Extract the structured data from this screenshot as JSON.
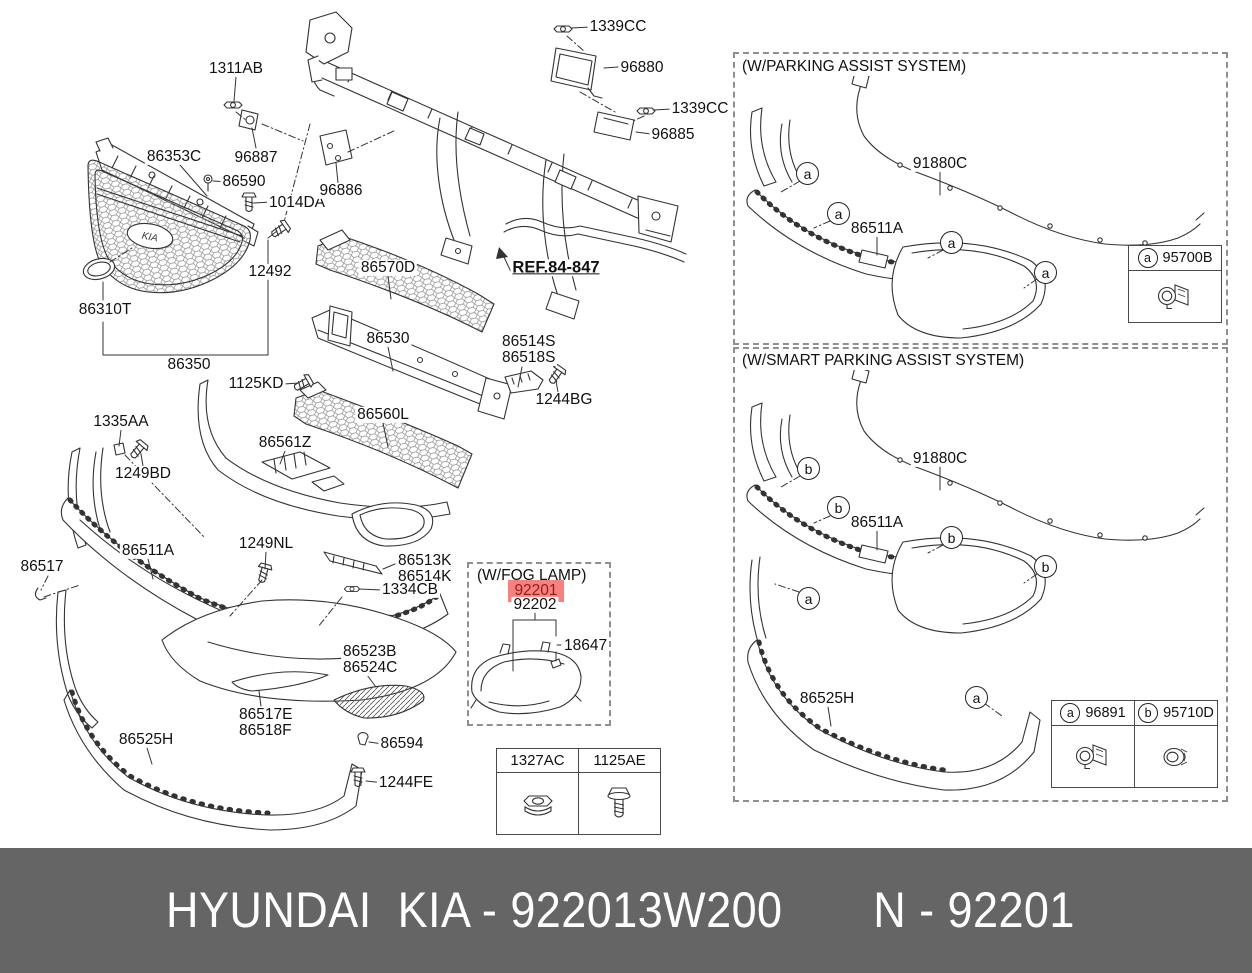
{
  "parts": {
    "1311AB": "1311AB",
    "96887": "96887",
    "86353C": "86353C",
    "86590": "86590",
    "1014DA": "1014DA",
    "96886": "96886",
    "12492": "12492",
    "86310T": "86310T",
    "86350": "86350",
    "86570D": "86570D",
    "86530": "86530",
    "86514S": "86514S",
    "86518S": "86518S",
    "1244BG": "1244BG",
    "86560L": "86560L",
    "86561Z": "86561Z",
    "1125KD": "1125KD",
    "1335AA": "1335AA",
    "1249BD": "1249BD",
    "86511A": "86511A",
    "1249NL": "1249NL",
    "86513K": "86513K",
    "86514K": "86514K",
    "1334CB": "1334CB",
    "86517": "86517",
    "86523B": "86523B",
    "86524C": "86524C",
    "86517E": "86517E",
    "86518F": "86518F",
    "86525H": "86525H",
    "86594": "86594",
    "1244FE": "1244FE",
    "1339CC": "1339CC",
    "96880": "96880",
    "96885": "96885",
    "91880C": "91880C",
    "95700B": "95700B",
    "96891": "96891",
    "95710D": "95710D",
    "92201": "92201",
    "92202": "92202",
    "18647": "18647",
    "1327AC": "1327AC",
    "1125AE": "1125AE"
  },
  "ref_label": "REF.84-847",
  "emblem": "KIA",
  "boxes": {
    "fog": {
      "title": "(W/FOG LAMP)"
    },
    "parking": {
      "title": "(W/PARKING ASSIST SYSTEM)"
    },
    "smart": {
      "title": "(W/SMART PARKING ASSIST SYSTEM)"
    }
  },
  "callouts": {
    "a": "a",
    "b": "b"
  },
  "banner": {
    "text": "HYUNDAI  KIA - 922013W200       N - 92201"
  },
  "colors": {
    "highlight_bg": "#f8807e",
    "highlight_fg": "#8c1f1f",
    "banner_bg": "#656565",
    "banner_fg": "#ffffff",
    "line": "#333333"
  }
}
